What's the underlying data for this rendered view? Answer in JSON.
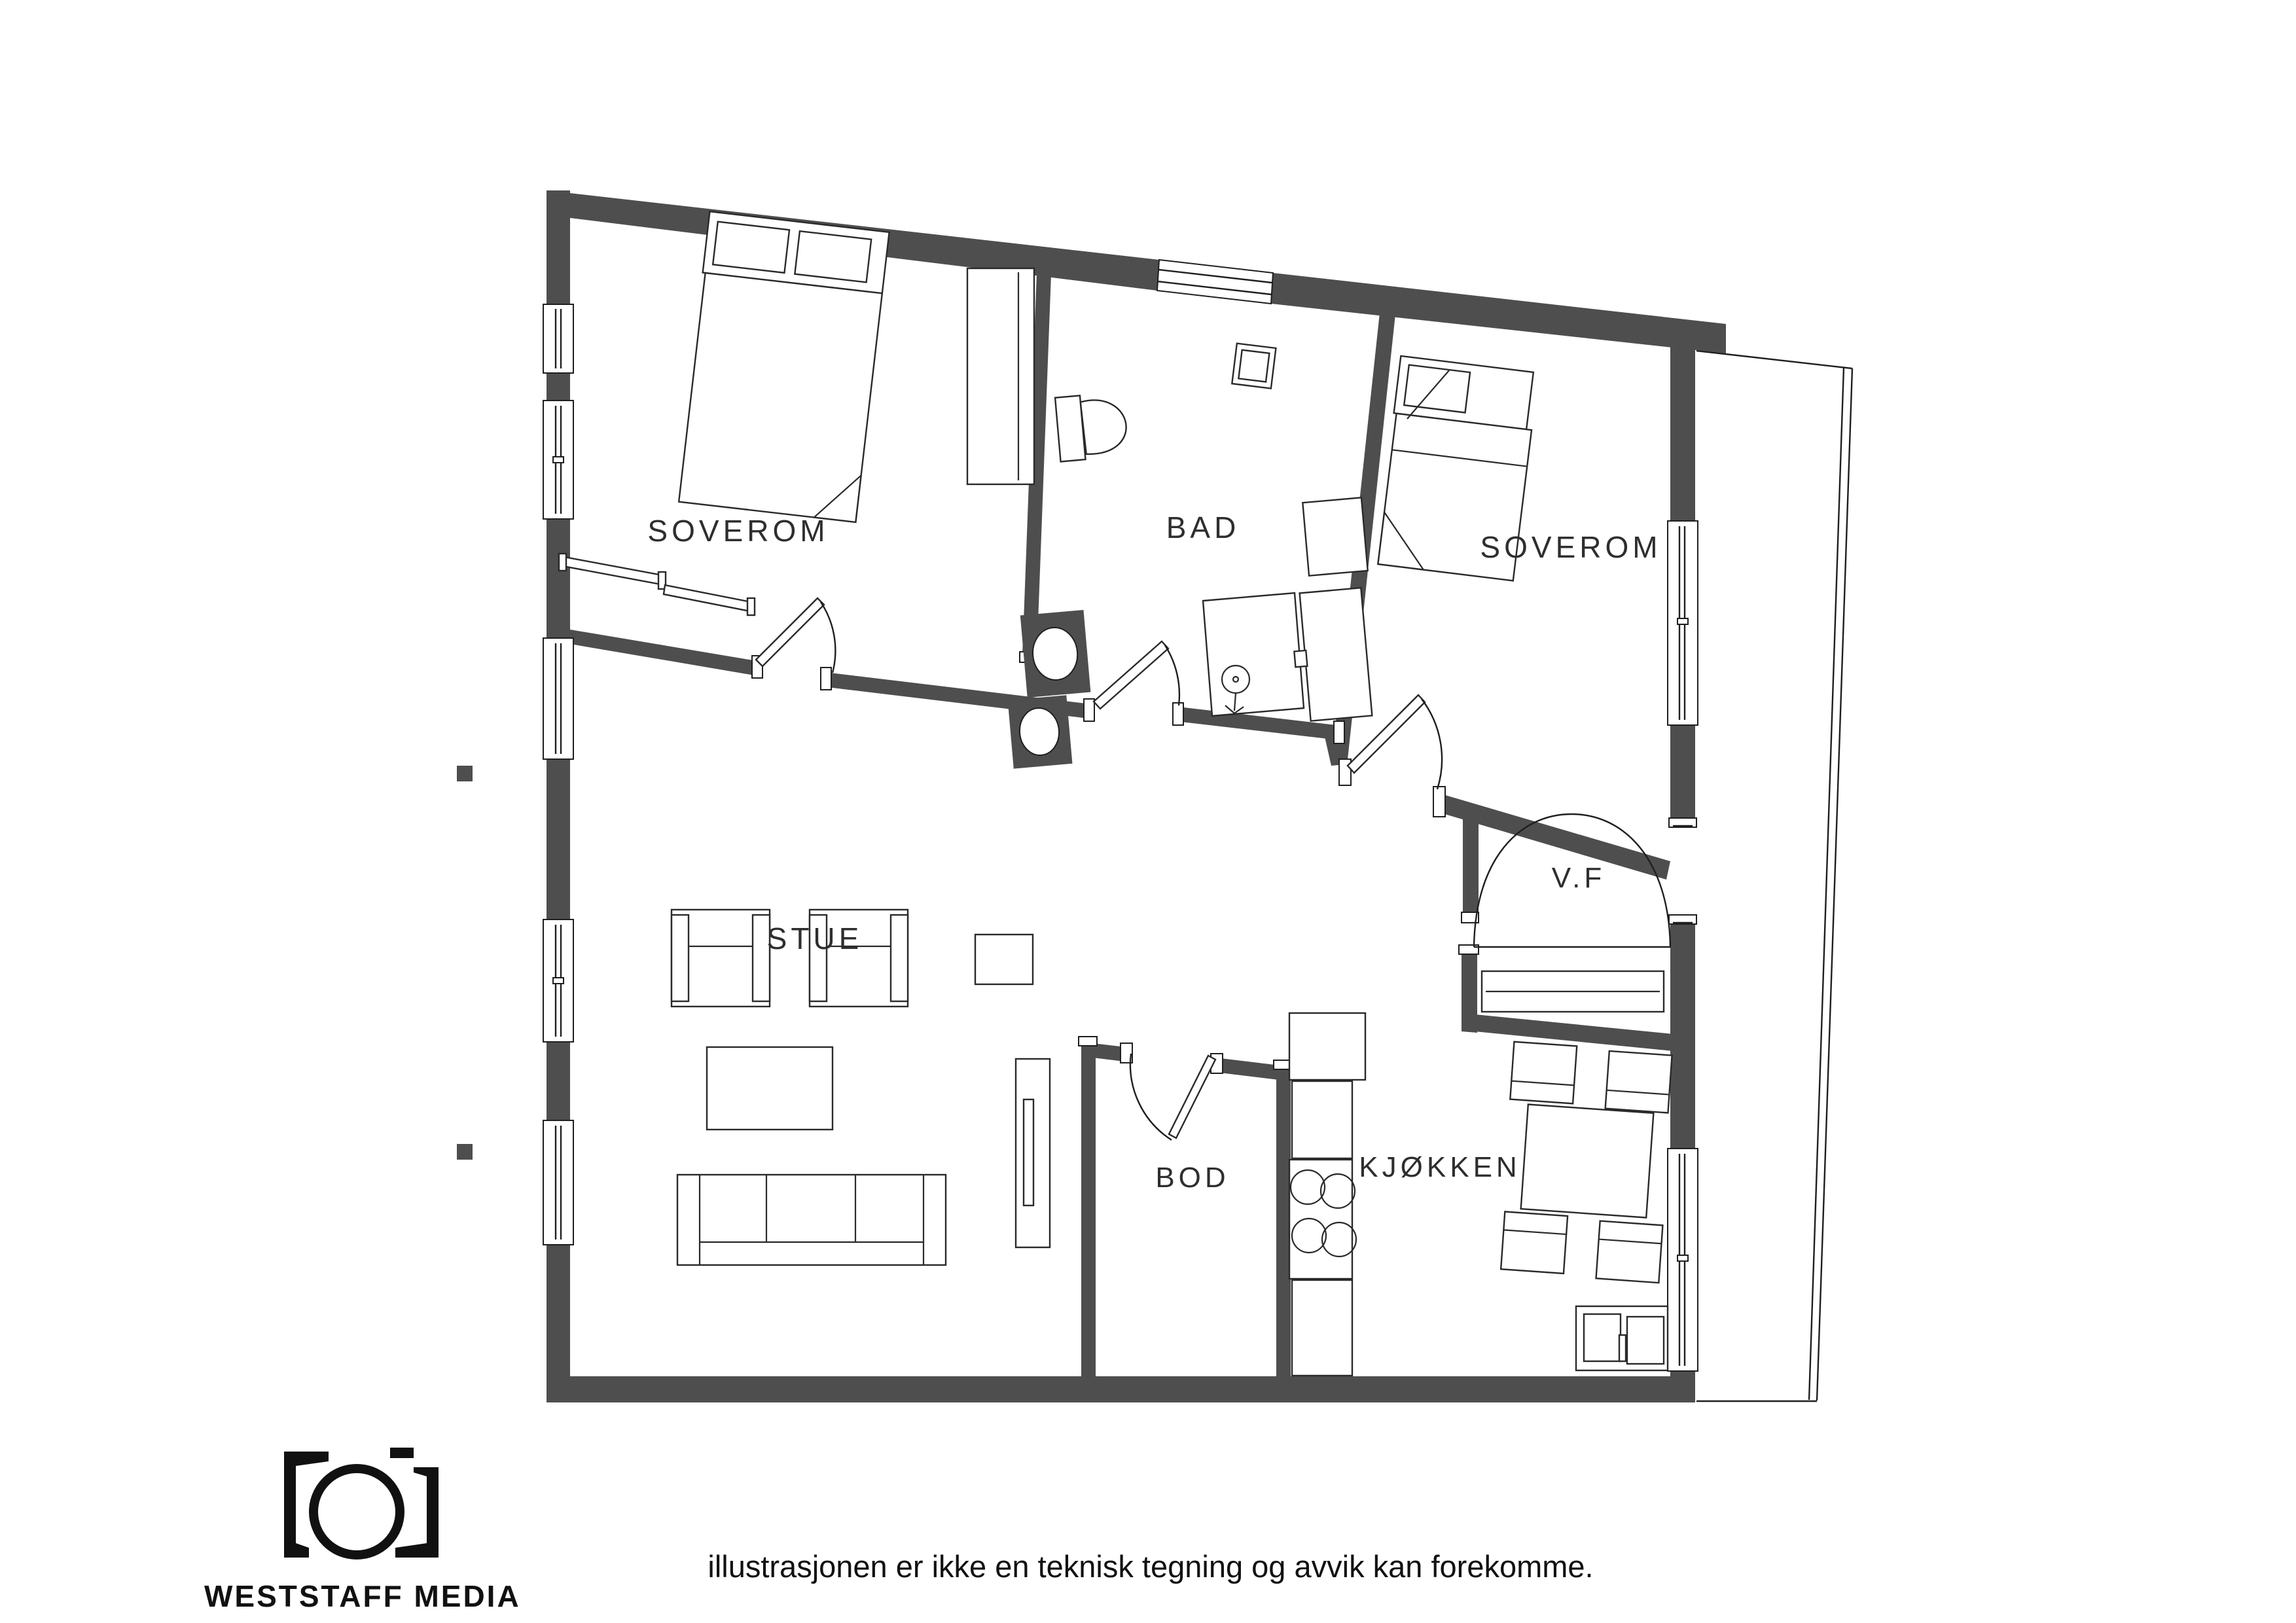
{
  "plan": {
    "wall_color": "#4e4e4e",
    "line_color": "#1f1f1f",
    "background": "#ffffff"
  },
  "rooms": {
    "bedroom1": "SOVEROM",
    "bathroom": "BAD",
    "bedroom2": "SOVEROM",
    "entry": "V.F",
    "living_room": "STUE",
    "storage": "BOD",
    "kitchen": "KJØKKEN"
  },
  "footer": {
    "brand": "WESTSTAFF MEDIA",
    "logo_icon": "camera-logo",
    "disclaimer": "illustrasjonen er ikke en teknisk tegning og avvik kan forekomme."
  }
}
